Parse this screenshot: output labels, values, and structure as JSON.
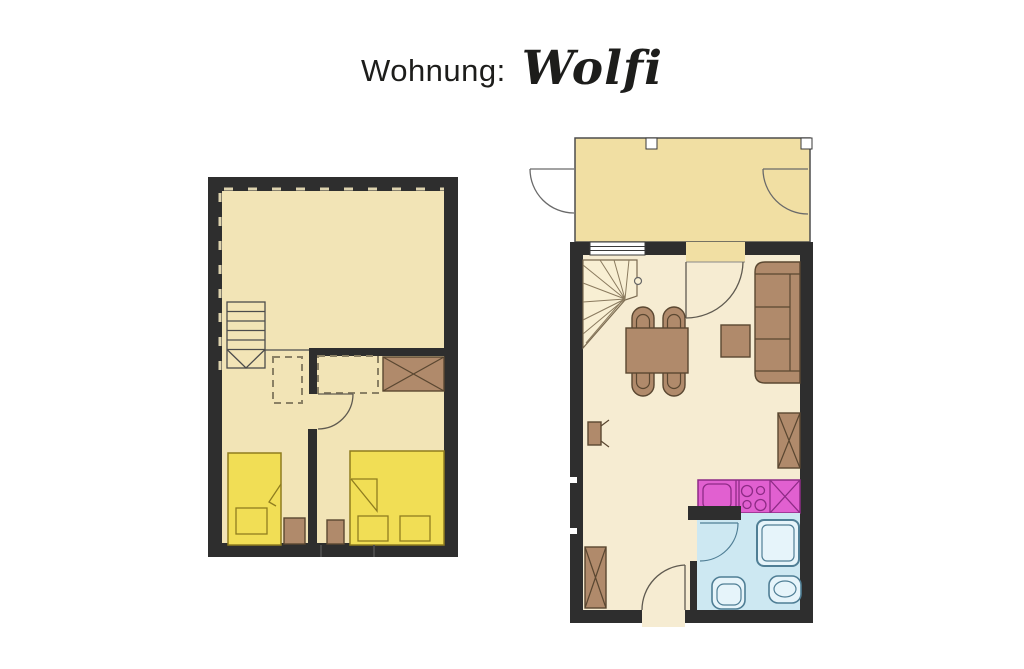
{
  "title": {
    "prefix": "Wohnung:",
    "apartment_name": "Wolfi"
  },
  "colors": {
    "background": "#ffffff",
    "wall": "#2e2e2e",
    "floor_upper": "#f2e4b6",
    "floor_main": "#f6ecd2",
    "balcony": "#f1dfa3",
    "stairs": "#f8efd3",
    "bed": "#f1de55",
    "bed_outline": "#8f7d1f",
    "furniture": "#b08a6b",
    "furniture_outline": "#5a4731",
    "kitchen": "#e160d0",
    "kitchen_outline": "#8e2b86",
    "bathroom_floor": "#cde8f2",
    "bathroom_fixture": "#e6f4fa",
    "bathroom_outline": "#4f7e95",
    "door_line": "#5f5a50",
    "dashed_furniture": "#8a8064"
  },
  "plans": [
    {
      "name": "upper-floor",
      "elements": [
        "straight-staircase-with-arrow",
        "dashed-wardrobe-outline",
        "dashed-wardrobe-outline",
        "wardrobe-crossed",
        "door-swing",
        "single-bed-with-pillow",
        "double-bed-with-two-pillows",
        "nightstand",
        "nightstand",
        "dashed-attic-slope-marks"
      ]
    },
    {
      "name": "main-floor",
      "elements": [
        "balcony",
        "balcony-downspout",
        "balcony-downspout",
        "exterior-door-swing",
        "exterior-door-swing",
        "window",
        "balcony-door-swing",
        "winder-staircase",
        "newel-post",
        "dining-table",
        "chair",
        "chair",
        "chair",
        "chair",
        "sofa-three-seat",
        "side-table",
        "tv-wall-mounted",
        "wardrobe-crossed",
        "wardrobe-crossed",
        "kitchen-sink-unit",
        "stove-four-burners",
        "kitchen-crossed-unit",
        "bathroom",
        "bathroom-door-swing",
        "shower",
        "toilet",
        "wash-basin",
        "entry-door-swing"
      ]
    }
  ]
}
